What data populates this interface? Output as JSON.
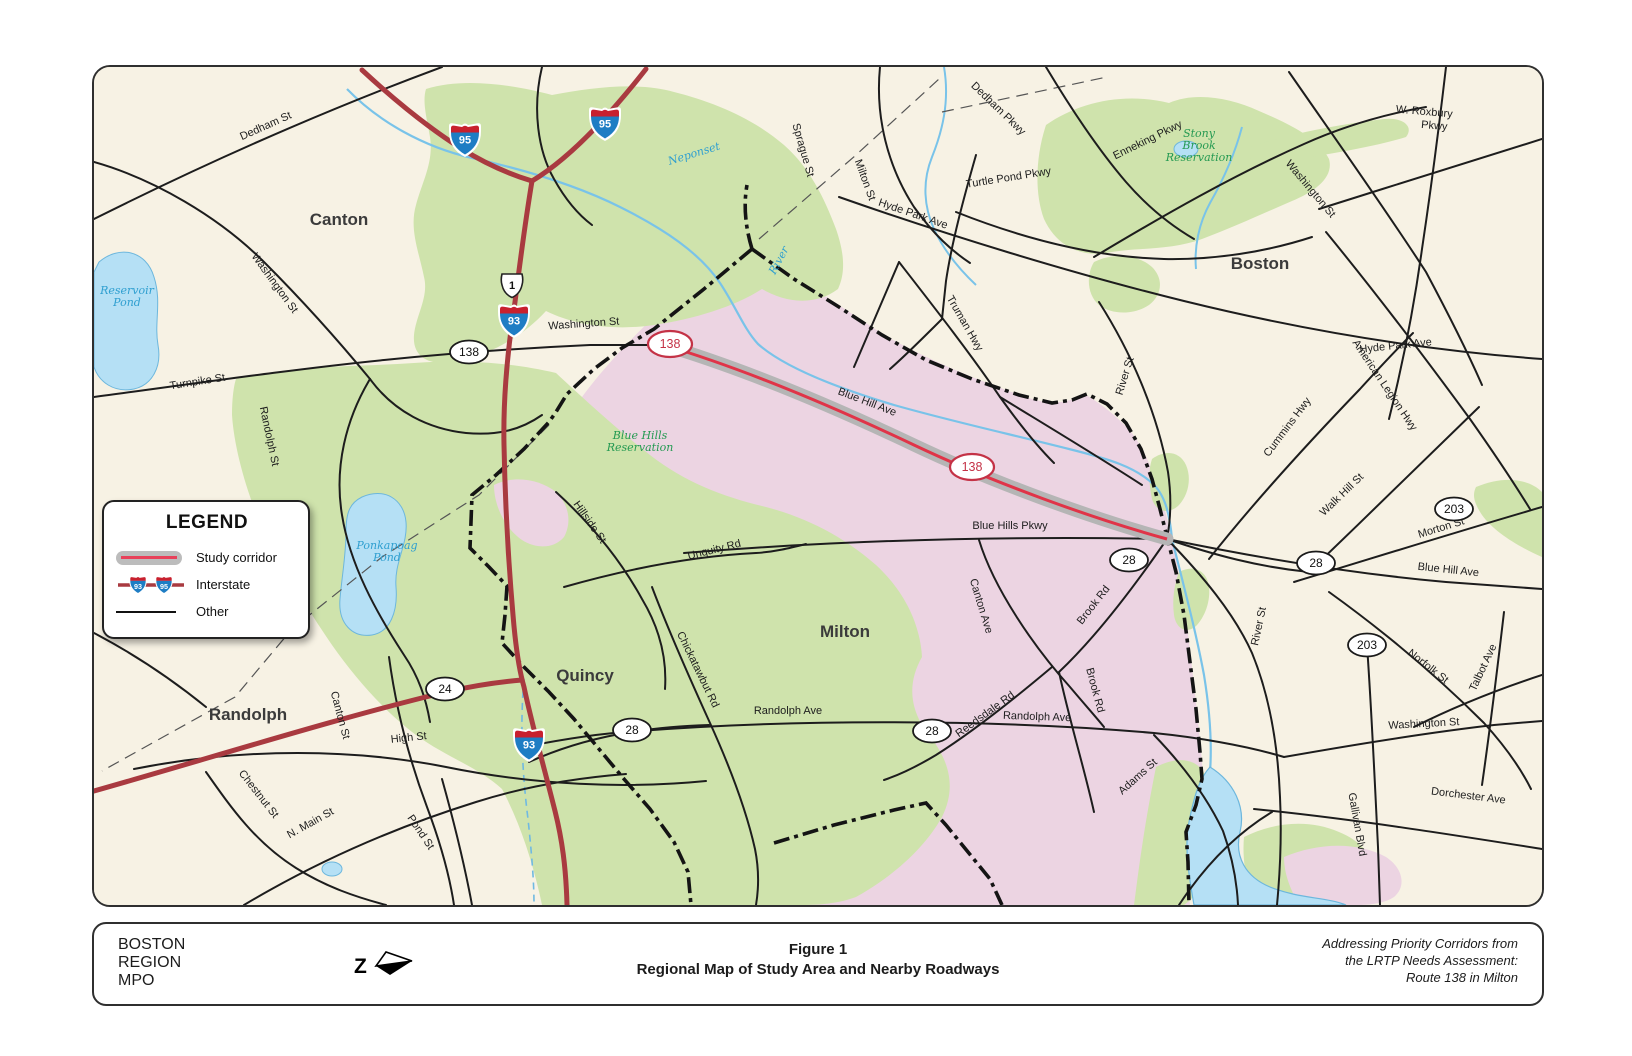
{
  "figure": {
    "org_lines": [
      "BOSTON",
      "REGION",
      "MPO"
    ],
    "title_line1": "Figure 1",
    "title_line2": "Regional Map of Study Area and Nearby Roadways",
    "credit_lines": [
      "Addressing Priority Corridors from",
      "the LRTP Needs Assessment:",
      "Route 138 in Milton"
    ]
  },
  "legend": {
    "title": "LEGEND",
    "items": [
      {
        "key": "study-corridor",
        "label": "Study corridor"
      },
      {
        "key": "interstate",
        "label": "Interstate",
        "shields": [
          "93",
          "95"
        ]
      },
      {
        "key": "other",
        "label": "Other"
      }
    ]
  },
  "map": {
    "colors": {
      "background": "#f7f2e4",
      "park_green": "#cfe3ac",
      "study_area_pink": "#ecd4e2",
      "water_fill": "#b5e0f5",
      "water_line": "#79c3e9",
      "road_black": "#1d1d1d",
      "interstate_red": "#a93a40",
      "corridor_gray": "#b5b5b5",
      "corridor_red": "#e03448",
      "boundary_black": "#141414",
      "town_label": "#3b3b3b",
      "park_label": "#259a52",
      "water_label": "#2f9fd0",
      "route_oval_red": "#c43246"
    },
    "towns": [
      {
        "text": "Canton",
        "x": 245,
        "y": 158
      },
      {
        "text": "Boston",
        "x": 1166,
        "y": 202
      },
      {
        "text": "Milton",
        "x": 751,
        "y": 570
      },
      {
        "text": "Quincy",
        "x": 491,
        "y": 614
      },
      {
        "text": "Randolph",
        "x": 154,
        "y": 653
      }
    ],
    "parks": [
      {
        "lines": [
          "Blue Hills",
          "Reservation"
        ],
        "x": 546,
        "y": 378
      },
      {
        "lines": [
          "Stony",
          "Brook",
          "Reservation"
        ],
        "x": 1105,
        "y": 82
      }
    ],
    "waters": [
      {
        "lines": [
          "Reservoir",
          "Pond"
        ],
        "x": 33,
        "y": 233,
        "rot": 0
      },
      {
        "lines": [
          "Ponkapoag",
          "Pond"
        ],
        "x": 293,
        "y": 488,
        "rot": 0
      },
      {
        "lines": [
          "Neponset"
        ],
        "x": 601,
        "y": 90,
        "rot": -17
      },
      {
        "lines": [
          "River"
        ],
        "x": 688,
        "y": 195,
        "rot": -62
      }
    ],
    "streets": [
      {
        "text": "Dedham St",
        "x": 173,
        "y": 62,
        "rot": -24
      },
      {
        "text": "Washington St",
        "x": 178,
        "y": 218,
        "rot": 54
      },
      {
        "text": "Turnpike St",
        "x": 104,
        "y": 318,
        "rot": -9
      },
      {
        "text": "Randolph St",
        "x": 172,
        "y": 370,
        "rot": 78
      },
      {
        "text": "Washington St",
        "x": 490,
        "y": 260,
        "rot": -4
      },
      {
        "text": "Sprague St",
        "x": 706,
        "y": 84,
        "rot": 74
      },
      {
        "text": "Milton St",
        "x": 768,
        "y": 114,
        "rot": 70
      },
      {
        "text": "Hyde Park Ave",
        "x": 818,
        "y": 150,
        "rot": 19
      },
      {
        "text": "Dedham Pkwy",
        "x": 902,
        "y": 44,
        "rot": 44
      },
      {
        "text": "Turtle Pond Pkwy",
        "x": 915,
        "y": 114,
        "rot": -9
      },
      {
        "text": "Enneking Pkwy",
        "x": 1055,
        "y": 76,
        "rot": -26
      },
      {
        "text": "Washington St",
        "x": 1214,
        "y": 124,
        "rot": 50
      },
      {
        "text": "W. Roxbury",
        "x": 1330,
        "y": 48,
        "rot": 5
      },
      {
        "text": "Pkwy",
        "x": 1340,
        "y": 62,
        "rot": 5
      },
      {
        "text": "Truman Hwy",
        "x": 868,
        "y": 258,
        "rot": 60
      },
      {
        "text": "Hyde Park Ave",
        "x": 1302,
        "y": 282,
        "rot": -6
      },
      {
        "text": "River St",
        "x": 1034,
        "y": 310,
        "rot": -73
      },
      {
        "text": "Cummins Hwy",
        "x": 1196,
        "y": 362,
        "rot": -53
      },
      {
        "text": "American Legion Hwy",
        "x": 1288,
        "y": 320,
        "rot": 56
      },
      {
        "text": "Walk Hill St",
        "x": 1250,
        "y": 430,
        "rot": -44
      },
      {
        "text": "Morton St",
        "x": 1348,
        "y": 464,
        "rot": -17
      },
      {
        "text": "Blue Hill Ave",
        "x": 1354,
        "y": 506,
        "rot": 6
      },
      {
        "text": "Norfolk St",
        "x": 1332,
        "y": 602,
        "rot": 38
      },
      {
        "text": "Talbot Ave",
        "x": 1392,
        "y": 602,
        "rot": -65
      },
      {
        "text": "Washington St",
        "x": 1330,
        "y": 660,
        "rot": -3
      },
      {
        "text": "Dorchester Ave",
        "x": 1374,
        "y": 732,
        "rot": 7
      },
      {
        "text": "Gallivan Blvd",
        "x": 1260,
        "y": 758,
        "rot": 80
      },
      {
        "text": "Adams St",
        "x": 1046,
        "y": 712,
        "rot": -42
      },
      {
        "text": "Blue Hill Ave",
        "x": 772,
        "y": 338,
        "rot": 21
      },
      {
        "text": "Blue Hills Pkwy",
        "x": 916,
        "y": 462,
        "rot": 0
      },
      {
        "text": "Canton Ave",
        "x": 884,
        "y": 540,
        "rot": 73
      },
      {
        "text": "Brook Rd",
        "x": 1002,
        "y": 540,
        "rot": -52
      },
      {
        "text": "Brook Rd",
        "x": 998,
        "y": 624,
        "rot": 75
      },
      {
        "text": "Reedsdale Rd",
        "x": 893,
        "y": 650,
        "rot": -36
      },
      {
        "text": "Randolph Ave",
        "x": 694,
        "y": 647,
        "rot": 0
      },
      {
        "text": "Randolph Ave",
        "x": 943,
        "y": 653,
        "rot": 2
      },
      {
        "text": "Unquity Rd",
        "x": 621,
        "y": 486,
        "rot": -14
      },
      {
        "text": "Hillside St",
        "x": 493,
        "y": 457,
        "rot": 55
      },
      {
        "text": "Chickatawbut Rd",
        "x": 601,
        "y": 604,
        "rot": 64
      },
      {
        "text": "Canton St",
        "x": 243,
        "y": 649,
        "rot": 75
      },
      {
        "text": "High St",
        "x": 315,
        "y": 674,
        "rot": -6
      },
      {
        "text": "Chestnut St",
        "x": 162,
        "y": 729,
        "rot": 52
      },
      {
        "text": "N. Main St",
        "x": 218,
        "y": 759,
        "rot": -29
      },
      {
        "text": "Pond St",
        "x": 324,
        "y": 767,
        "rot": 56
      },
      {
        "text": "River St",
        "x": 1168,
        "y": 560,
        "rot": -78
      }
    ],
    "shields": [
      {
        "type": "interstate",
        "label": "95",
        "x": 371,
        "y": 73
      },
      {
        "type": "interstate",
        "label": "95",
        "x": 511,
        "y": 57
      },
      {
        "type": "us",
        "label": "1",
        "x": 418,
        "y": 218
      },
      {
        "type": "interstate",
        "label": "93",
        "x": 420,
        "y": 254
      },
      {
        "type": "interstate",
        "label": "93",
        "x": 435,
        "y": 678
      },
      {
        "type": "oval",
        "label": "138",
        "x": 375,
        "y": 285
      },
      {
        "type": "oval_red",
        "label": "138",
        "x": 576,
        "y": 277
      },
      {
        "type": "oval_red",
        "label": "138",
        "x": 878,
        "y": 400
      },
      {
        "type": "oval",
        "label": "24",
        "x": 351,
        "y": 622
      },
      {
        "type": "oval",
        "label": "28",
        "x": 538,
        "y": 663
      },
      {
        "type": "oval",
        "label": "28",
        "x": 838,
        "y": 664
      },
      {
        "type": "oval",
        "label": "28",
        "x": 1035,
        "y": 493
      },
      {
        "type": "oval",
        "label": "28",
        "x": 1222,
        "y": 496
      },
      {
        "type": "oval",
        "label": "203",
        "x": 1360,
        "y": 442
      },
      {
        "type": "oval",
        "label": "203",
        "x": 1273,
        "y": 578
      }
    ]
  }
}
